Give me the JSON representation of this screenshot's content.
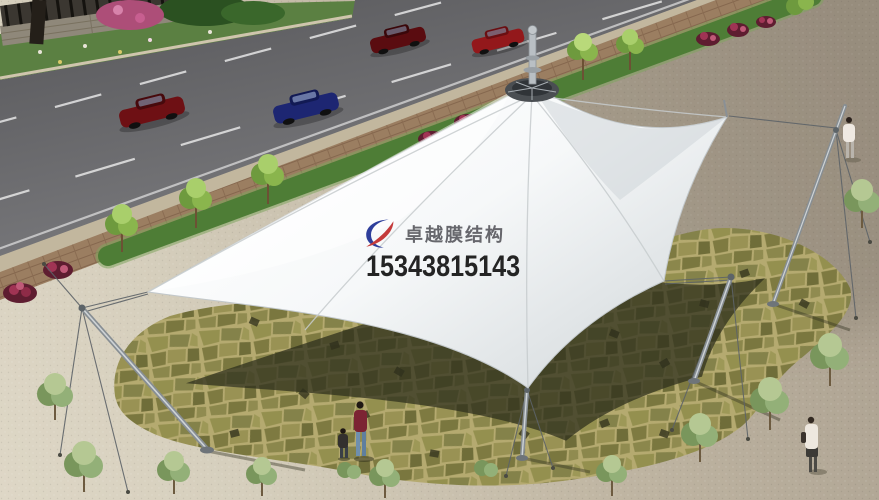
{
  "watermark": {
    "brand": "卓越膜结构",
    "phone": "15343815143"
  },
  "colors": {
    "logo-blue": "#2e3e9b",
    "logo-red": "#c43b3b",
    "brand-text": "#4e4e54",
    "phone-text": "#131313",
    "membrane": "#f5f7f8",
    "membrane-shade": "#dde2e4",
    "road": "#6f6f72",
    "plaza-light": "#ded7c6",
    "plaza-dark": "#a89d8d",
    "flagstone": "#b5aa70",
    "canopy-shadow": "#2e2f1c",
    "lawn": "#4e7d36",
    "steel": "#878e93",
    "car1": "#6e1014",
    "car2": "#1d2672",
    "car3": "#5a0c10",
    "car4": "#93181b"
  }
}
